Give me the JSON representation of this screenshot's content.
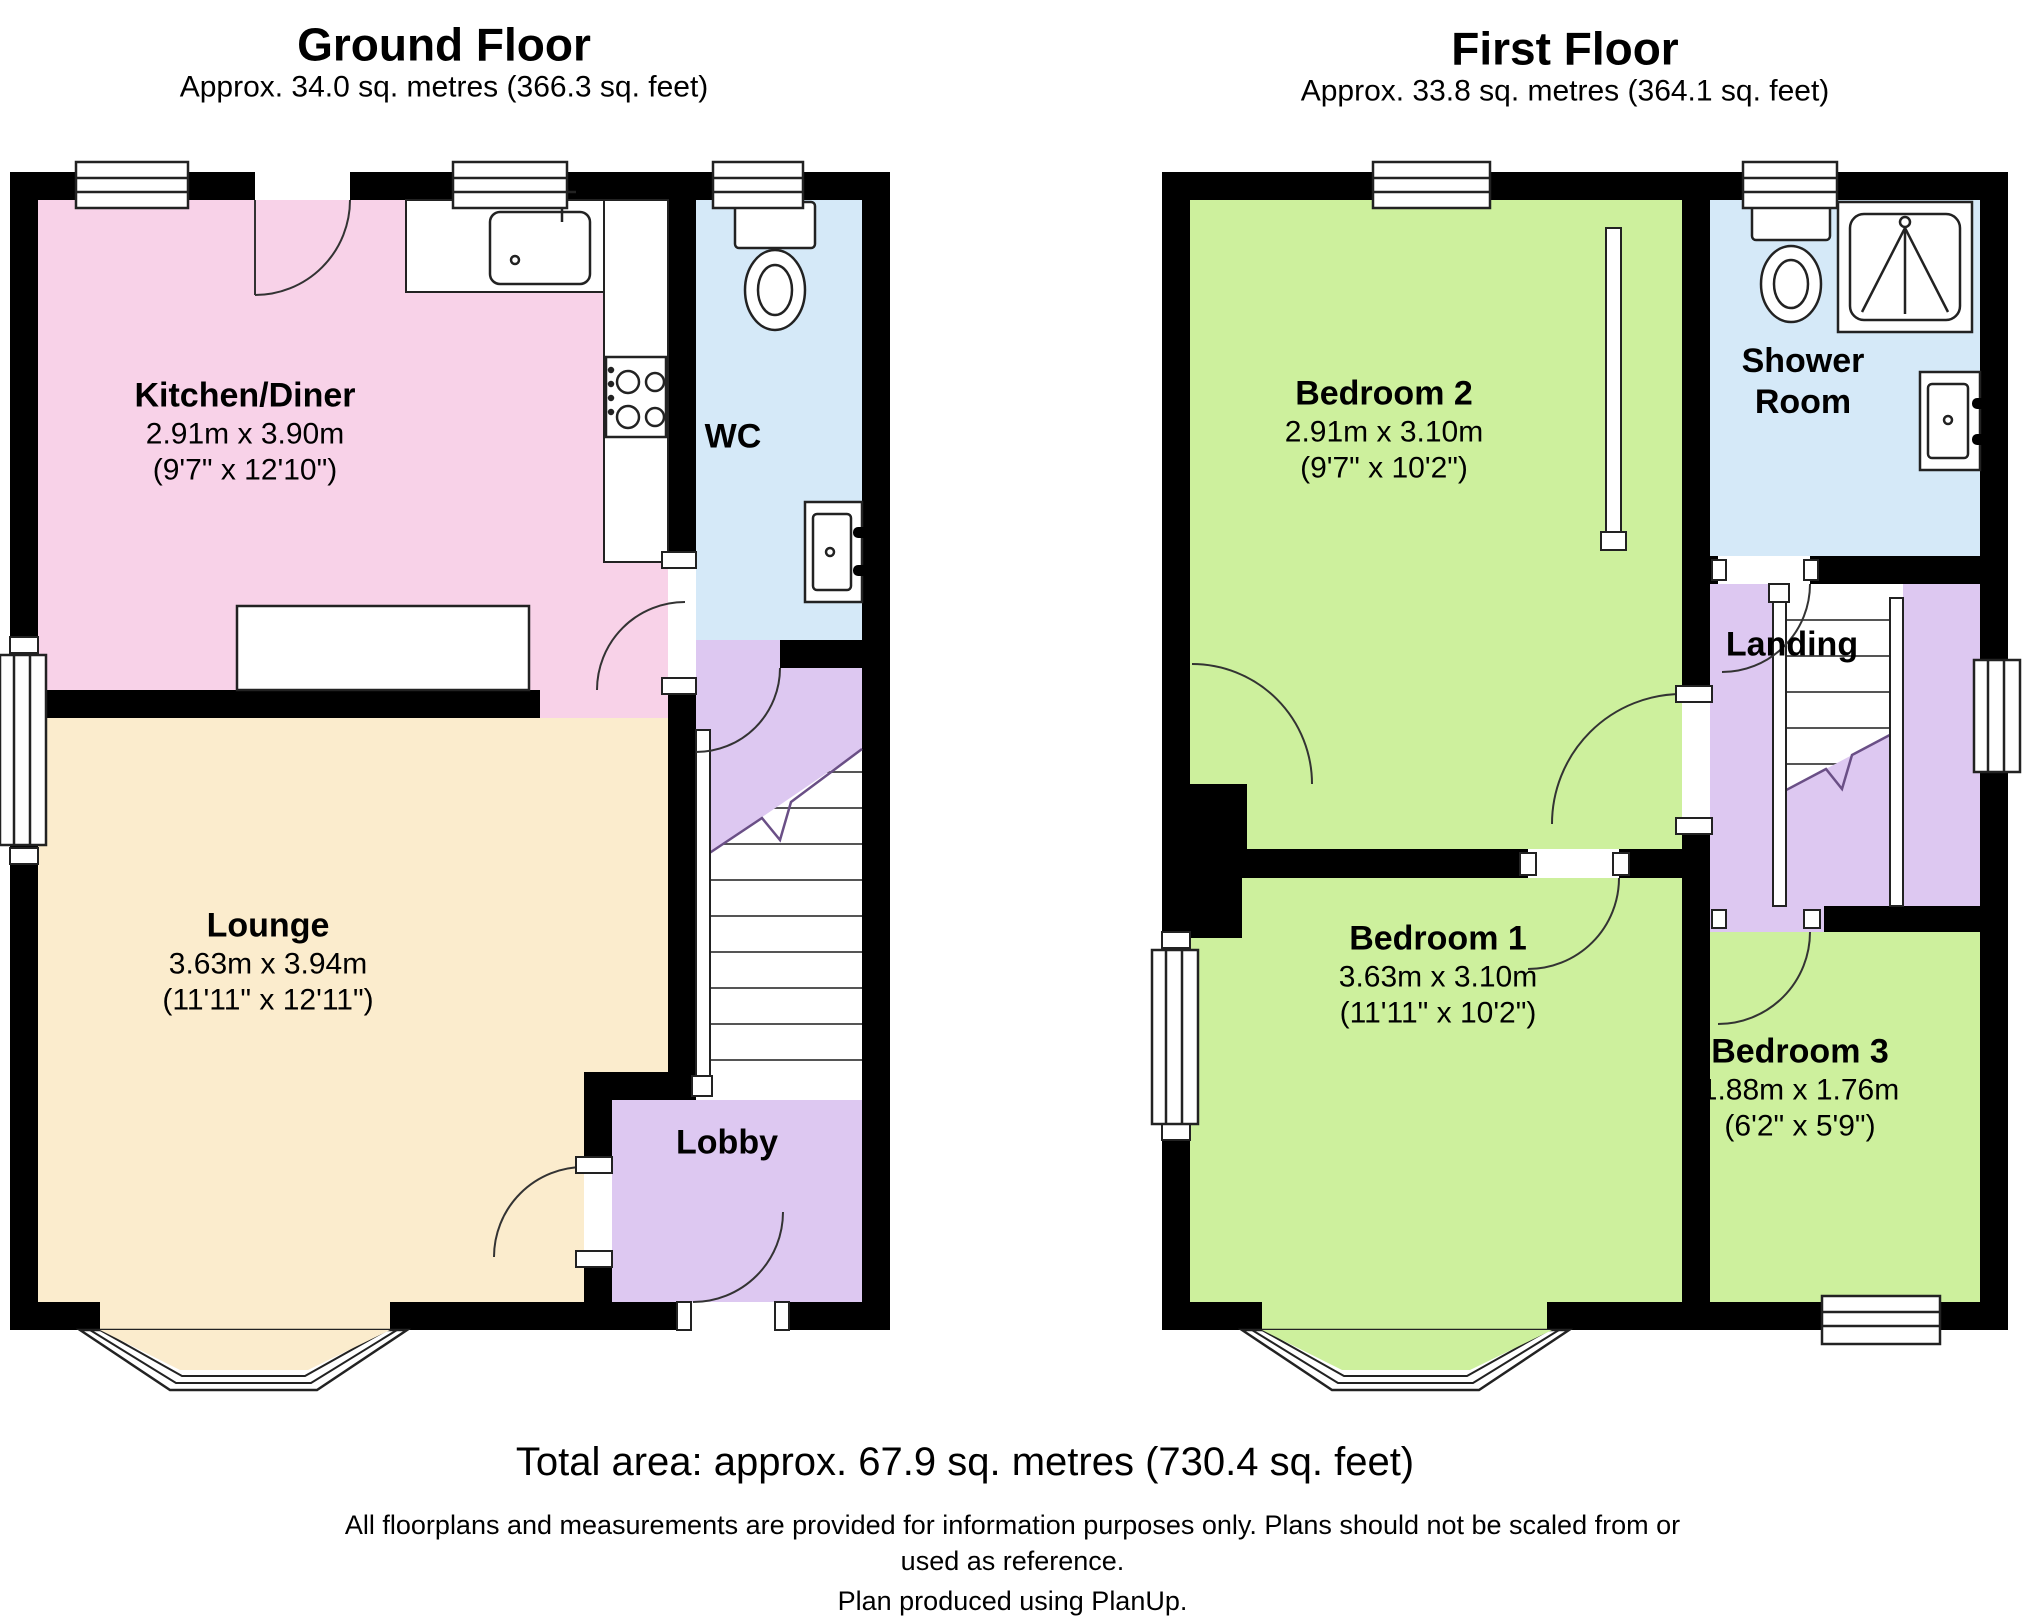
{
  "ground_floor": {
    "title": "Ground Floor",
    "subtitle": "Approx. 34.0 sq. metres (366.3 sq. feet)",
    "rooms": {
      "kitchen": {
        "name": "Kitchen/Diner",
        "metric": "2.91m x 3.90m",
        "imperial": "(9'7\" x 12'10\")"
      },
      "wc": {
        "name": "WC"
      },
      "lounge": {
        "name": "Lounge",
        "metric": "3.63m x 3.94m",
        "imperial": "(11'11\" x 12'11\")"
      },
      "lobby": {
        "name": "Lobby"
      }
    }
  },
  "first_floor": {
    "title": "First Floor",
    "subtitle": "Approx. 33.8 sq. metres (364.1 sq. feet)",
    "rooms": {
      "bedroom2": {
        "name": "Bedroom 2",
        "metric": "2.91m x 3.10m",
        "imperial": "(9'7\" x 10'2\")"
      },
      "shower": {
        "name_line1": "Shower",
        "name_line2": "Room"
      },
      "landing": {
        "name": "Landing"
      },
      "bedroom1": {
        "name": "Bedroom 1",
        "metric": "3.63m x 3.10m",
        "imperial": "(11'11\" x 10'2\")"
      },
      "bedroom3": {
        "name": "Bedroom 3",
        "metric": "1.88m x 1.76m",
        "imperial": "(6'2\" x 5'9\")"
      }
    }
  },
  "footer": {
    "total_area": "Total area: approx. 67.9 sq. metres (730.4 sq. feet)",
    "disclaimer_line1": "All floorplans and measurements are provided for information purposes only. Plans should not be scaled from or",
    "disclaimer_line2": "used as reference.",
    "disclaimer_line3": "Plan produced using PlanUp."
  },
  "colors": {
    "wall": "#000000",
    "kitchen": "#f8d2e8",
    "lounge": "#fbeccd",
    "bathroom": "#d5e9f8",
    "hall": "#ddc8f1",
    "bedroom": "#cdf09d"
  }
}
